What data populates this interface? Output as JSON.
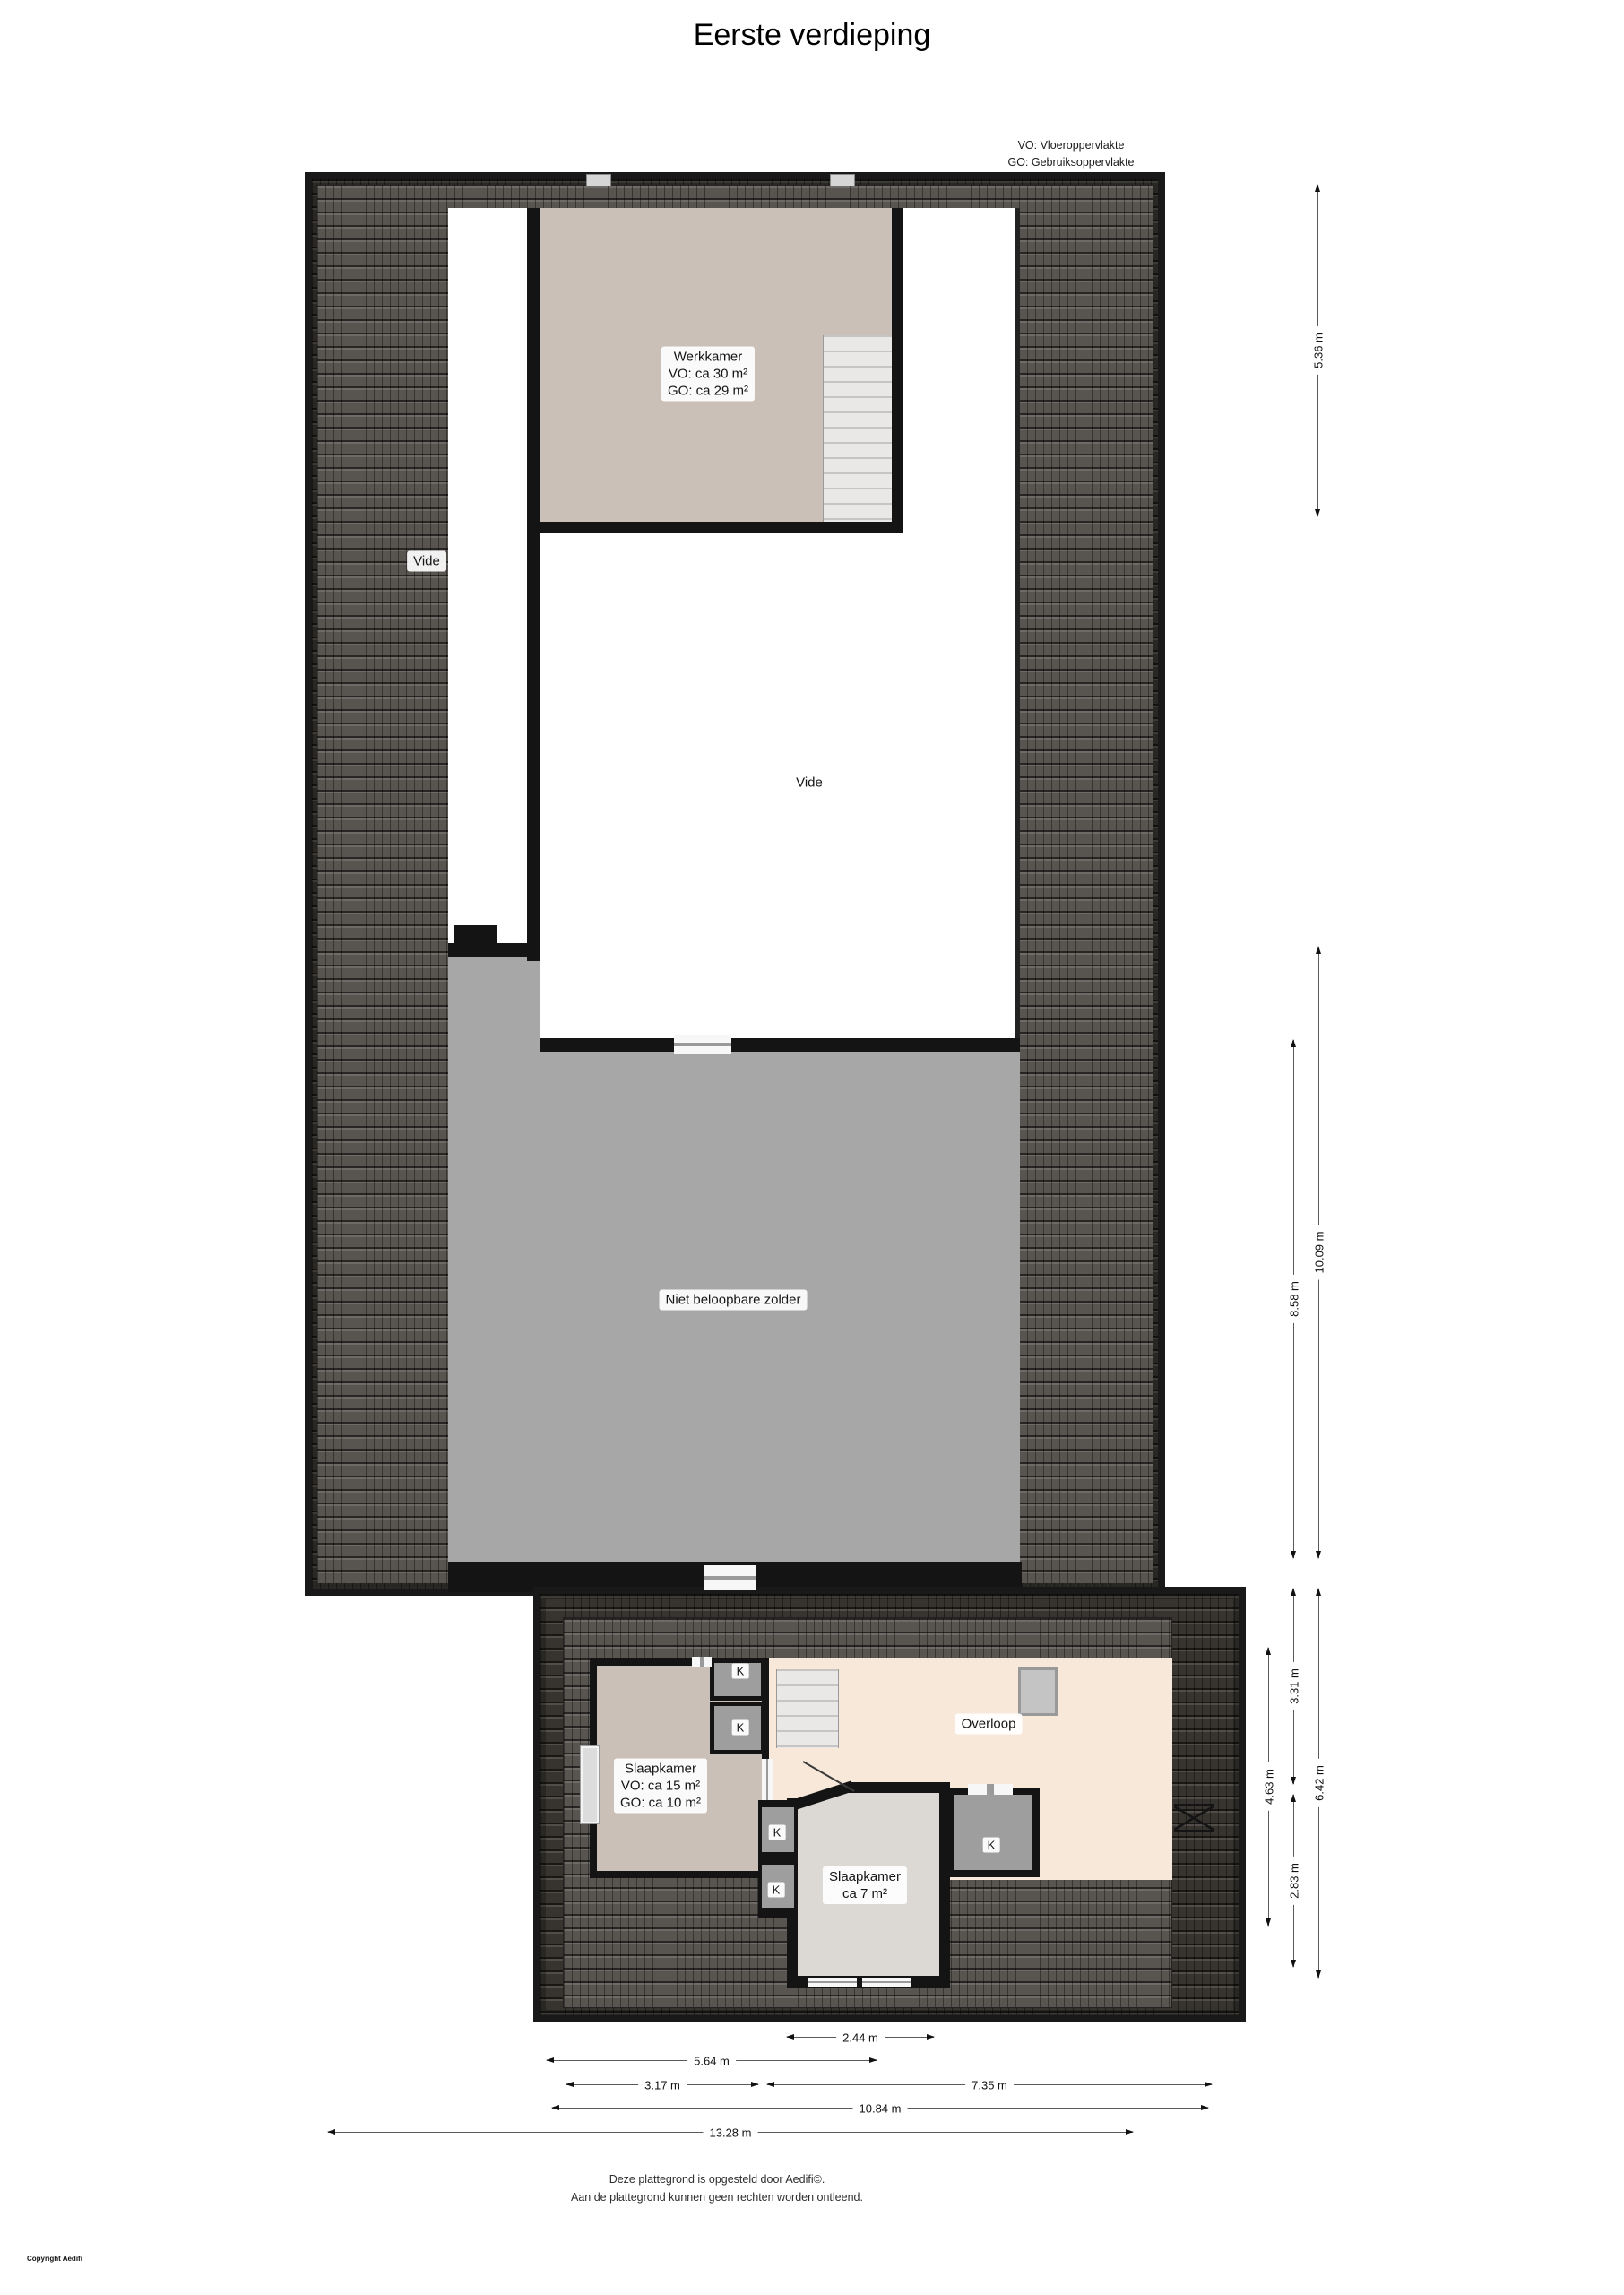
{
  "title": "Eerste verdieping",
  "legend": {
    "line1": "VO: Vloeroppervlakte",
    "line2": "GO: Gebruiksoppervlakte"
  },
  "rooms": {
    "werkkamer": {
      "name": "Werkkamer",
      "vo": "VO: ca 30 m²",
      "go": "GO: ca 29 m²"
    },
    "vide_left": {
      "name": "Vide"
    },
    "vide_center": {
      "name": "Vide"
    },
    "zolder": {
      "name": "Niet beloopbare zolder"
    },
    "slaapkamer_1": {
      "name": "Slaapkamer",
      "vo": "VO: ca 15 m²",
      "go": "GO: ca 10 m²"
    },
    "overloop": {
      "name": "Overloop"
    },
    "slaapkamer_2": {
      "name": "Slaapkamer",
      "area": "ca 7 m²"
    },
    "closet_label": "K"
  },
  "dimensions": {
    "vertical": [
      {
        "id": "top-right",
        "label": "5.36 m"
      },
      {
        "id": "zolder-outer",
        "label": "10.09 m"
      },
      {
        "id": "zolder-inner",
        "label": "8.58 m"
      },
      {
        "id": "lower-top",
        "label": "3.31 m"
      },
      {
        "id": "lower-outer",
        "label": "6.42 m"
      },
      {
        "id": "lower-inner",
        "label": "4.63 m"
      },
      {
        "id": "lower-bottom",
        "label": "2.83 m"
      }
    ],
    "horizontal": [
      {
        "id": "w-244",
        "label": "2.44 m"
      },
      {
        "id": "w-564",
        "label": "5.64 m"
      },
      {
        "id": "w-317",
        "label": "3.17 m"
      },
      {
        "id": "w-735",
        "label": "7.35 m"
      },
      {
        "id": "w-1084",
        "label": "10.84 m"
      },
      {
        "id": "w-1328",
        "label": "13.28 m"
      }
    ]
  },
  "footer": {
    "line1": "Deze plattegrond is opgesteld door Aedifi©.",
    "line2": "Aan de plattegrond kunnen geen rechten worden ontleend.",
    "copyright": "Copyright Aedifi"
  },
  "colors": {
    "roof_dark": "#37342f",
    "roof_light": "#585450",
    "wall": "#141414",
    "room_beige": "#cbc0b7",
    "overloop_cream": "#f8e8da",
    "zolder_gray": "#a7a7a7",
    "closet_gray": "#9e9e9e",
    "stairs": "#eae8e6",
    "slaapkamer2_gray": "#dcd9d4"
  }
}
